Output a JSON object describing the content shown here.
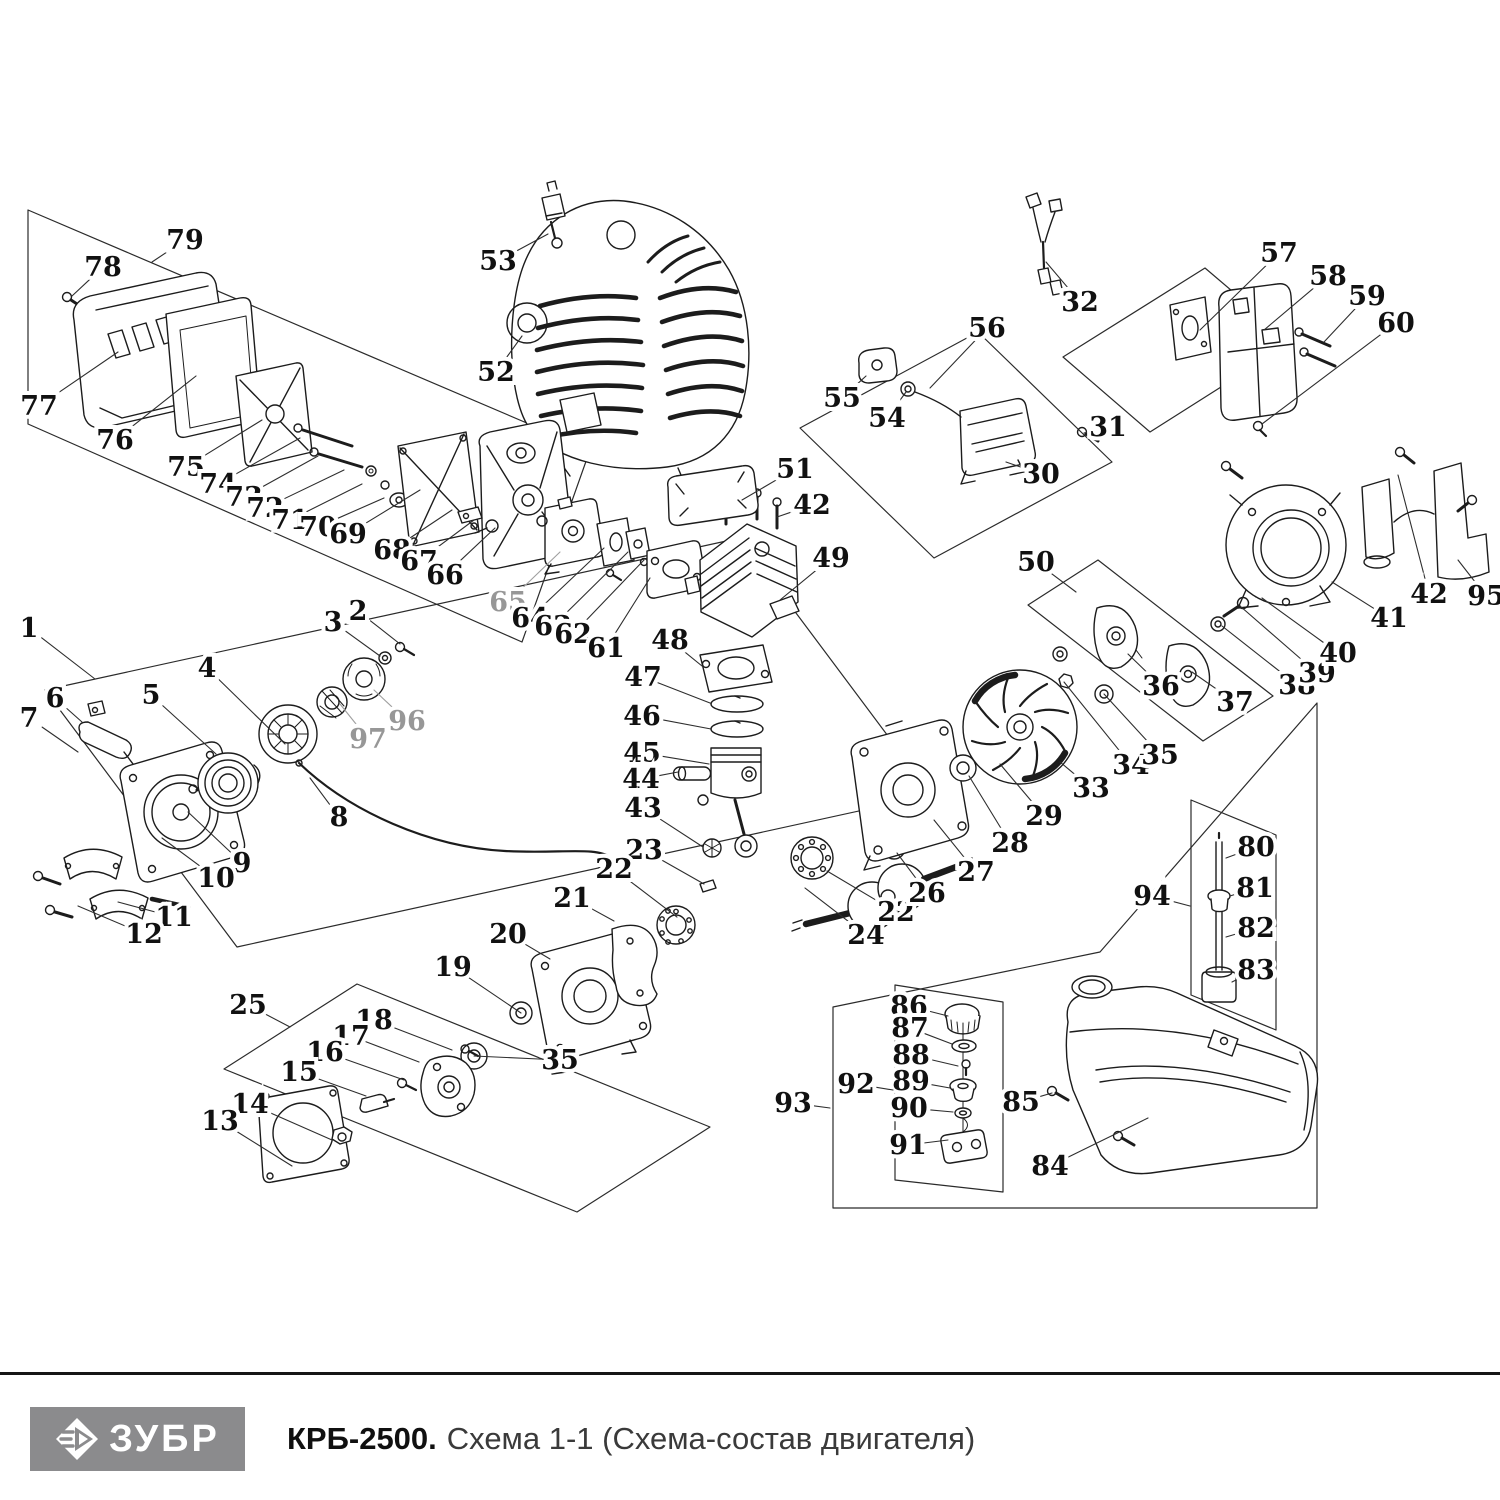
{
  "footer": {
    "brand": "ЗУБР",
    "model": "КРБ-2500.",
    "subtitle": "Схема 1-1 (Схема-состав двигателя)"
  },
  "colors": {
    "line": "#1c1c1c",
    "label": "#111111",
    "muted_label": "#979797",
    "leader": "#2e2e2e",
    "logo_bg": "#8b8b8d",
    "rule": "#161616",
    "subtitle_gray": "#3a3a3a"
  },
  "diagram": {
    "description": "Exploded parts schematic of brushcutter engine with numbered callouts",
    "labels": [
      [
        "79",
        185,
        240,
        152,
        262,
        0
      ],
      [
        "78",
        103,
        267,
        72,
        296,
        0
      ],
      [
        "77",
        39,
        406,
        118,
        352,
        0
      ],
      [
        "76",
        115,
        440,
        196,
        376,
        0
      ],
      [
        "75",
        186,
        467,
        262,
        420,
        0
      ],
      [
        "74",
        218,
        484,
        300,
        438,
        0
      ],
      [
        "73",
        244,
        497,
        318,
        456,
        0
      ],
      [
        "72",
        265,
        508,
        344,
        470,
        0
      ],
      [
        "71",
        290,
        520,
        362,
        484,
        0
      ],
      [
        "70",
        318,
        527,
        384,
        498,
        0
      ],
      [
        "69",
        348,
        534,
        420,
        490,
        0
      ],
      [
        "68",
        392,
        550,
        452,
        510,
        0
      ],
      [
        "67",
        419,
        561,
        474,
        520,
        0
      ],
      [
        "66",
        445,
        575,
        495,
        528,
        0
      ],
      [
        "65",
        508,
        602,
        560,
        552,
        1
      ],
      [
        "64",
        530,
        618,
        604,
        548,
        0
      ],
      [
        "63",
        553,
        626,
        628,
        552,
        0
      ],
      [
        "62",
        573,
        634,
        644,
        560,
        0
      ],
      [
        "61",
        606,
        648,
        650,
        578,
        0
      ],
      [
        "53",
        498,
        261,
        548,
        234,
        0
      ],
      [
        "52",
        496,
        372,
        522,
        336,
        0
      ],
      [
        "51",
        795,
        469,
        742,
        500,
        0
      ],
      [
        "42",
        812,
        505,
        777,
        517,
        0
      ],
      [
        "49",
        831,
        558,
        780,
        600,
        0
      ],
      [
        "48",
        670,
        640,
        702,
        666,
        0
      ],
      [
        "47",
        643,
        677,
        710,
        703,
        0
      ],
      [
        "46",
        642,
        716,
        711,
        729,
        0
      ],
      [
        "45",
        642,
        753,
        709,
        764,
        0
      ],
      [
        "44",
        641,
        779,
        678,
        772,
        0
      ],
      [
        "43",
        643,
        808,
        703,
        847,
        0
      ],
      [
        "23",
        644,
        850,
        704,
        884,
        0
      ],
      [
        "22",
        614,
        869,
        677,
        917,
        0
      ],
      [
        "21",
        572,
        898,
        614,
        921,
        0
      ],
      [
        "20",
        508,
        934,
        550,
        959,
        0
      ],
      [
        "19",
        453,
        967,
        521,
        1013,
        0
      ],
      [
        "35",
        560,
        1060,
        474,
        1056,
        0
      ],
      [
        "25",
        248,
        1005,
        290,
        1027,
        0
      ],
      [
        "18",
        374,
        1020,
        452,
        1050,
        0
      ],
      [
        "17",
        351,
        1036,
        419,
        1062,
        0
      ],
      [
        "16",
        325,
        1052,
        404,
        1080,
        0
      ],
      [
        "15",
        299,
        1072,
        366,
        1096,
        0
      ],
      [
        "14",
        250,
        1104,
        332,
        1140,
        0
      ],
      [
        "13",
        220,
        1121,
        292,
        1166,
        0
      ],
      [
        "1",
        29,
        628,
        95,
        679,
        0
      ],
      [
        "2",
        358,
        611,
        400,
        644,
        0
      ],
      [
        "3",
        333,
        622,
        380,
        656,
        0
      ],
      [
        "4",
        207,
        668,
        285,
        744,
        0
      ],
      [
        "5",
        151,
        695,
        216,
        754,
        0
      ],
      [
        "6",
        55,
        698,
        82,
        722,
        0
      ],
      [
        "7",
        29,
        718,
        78,
        752,
        0
      ],
      [
        "96",
        407,
        721,
        374,
        690,
        1
      ],
      [
        "97",
        368,
        739,
        340,
        704,
        1
      ],
      [
        "8",
        339,
        817,
        310,
        778,
        0
      ],
      [
        "9",
        242,
        863,
        188,
        812,
        0
      ],
      [
        "10",
        216,
        878,
        162,
        838,
        0
      ],
      [
        "11",
        174,
        917,
        118,
        902,
        0
      ],
      [
        "12",
        144,
        934,
        78,
        906,
        0
      ],
      [
        "24",
        866,
        935,
        805,
        888,
        0
      ],
      [
        "22",
        896,
        912,
        827,
        871,
        0
      ],
      [
        "26",
        927,
        893,
        897,
        853,
        0
      ],
      [
        "27",
        976,
        872,
        934,
        820,
        0
      ],
      [
        "28",
        1010,
        843,
        969,
        776,
        0
      ],
      [
        "29",
        1044,
        816,
        1000,
        764,
        0
      ],
      [
        "33",
        1091,
        788,
        1060,
        762,
        0
      ],
      [
        "34",
        1131,
        765,
        1064,
        682,
        0
      ],
      [
        "35",
        1160,
        755,
        1104,
        694,
        0
      ],
      [
        "36",
        1161,
        686,
        1128,
        654,
        0
      ],
      [
        "37",
        1235,
        702,
        1192,
        672,
        0
      ],
      [
        "38",
        1297,
        685,
        1222,
        626,
        0
      ],
      [
        "39",
        1317,
        673,
        1240,
        606,
        0
      ],
      [
        "40",
        1338,
        653,
        1262,
        598,
        0
      ],
      [
        "41",
        1389,
        618,
        1332,
        582,
        0
      ],
      [
        "42",
        1429,
        594,
        1398,
        475,
        0
      ],
      [
        "95",
        1486,
        596,
        1458,
        560,
        0
      ],
      [
        "50",
        1036,
        562,
        1076,
        592,
        0
      ],
      [
        "30",
        1041,
        474,
        1006,
        462,
        0
      ],
      [
        "31",
        1108,
        427,
        1084,
        433,
        0
      ],
      [
        "32",
        1080,
        302,
        1046,
        262,
        0
      ],
      [
        "56",
        987,
        328,
        930,
        388,
        0
      ],
      [
        "55",
        842,
        398,
        866,
        376,
        0
      ],
      [
        "54",
        887,
        418,
        906,
        392,
        0
      ],
      [
        "57",
        1279,
        253,
        1200,
        330,
        0
      ],
      [
        "58",
        1328,
        276,
        1264,
        330,
        0
      ],
      [
        "59",
        1367,
        296,
        1324,
        342,
        0
      ],
      [
        "60",
        1396,
        323,
        1262,
        424,
        0
      ],
      [
        "80",
        1256,
        847,
        1226,
        858,
        0
      ],
      [
        "81",
        1255,
        888,
        1230,
        896,
        0
      ],
      [
        "82",
        1256,
        928,
        1226,
        937,
        0
      ],
      [
        "83",
        1256,
        970,
        1232,
        982,
        0
      ],
      [
        "94",
        1152,
        896,
        1190,
        906,
        0
      ],
      [
        "84",
        1050,
        1166,
        1148,
        1118,
        0
      ],
      [
        "85",
        1021,
        1102,
        1052,
        1093,
        0
      ],
      [
        "86",
        909,
        1006,
        948,
        1016,
        0
      ],
      [
        "87",
        910,
        1028,
        952,
        1044,
        0
      ],
      [
        "88",
        911,
        1055,
        958,
        1066,
        0
      ],
      [
        "89",
        911,
        1081,
        950,
        1088,
        0
      ],
      [
        "90",
        909,
        1108,
        953,
        1112,
        0
      ],
      [
        "91",
        908,
        1145,
        948,
        1140,
        0
      ],
      [
        "92",
        856,
        1084,
        893,
        1090,
        0
      ],
      [
        "93",
        793,
        1103,
        830,
        1108,
        0
      ]
    ]
  }
}
